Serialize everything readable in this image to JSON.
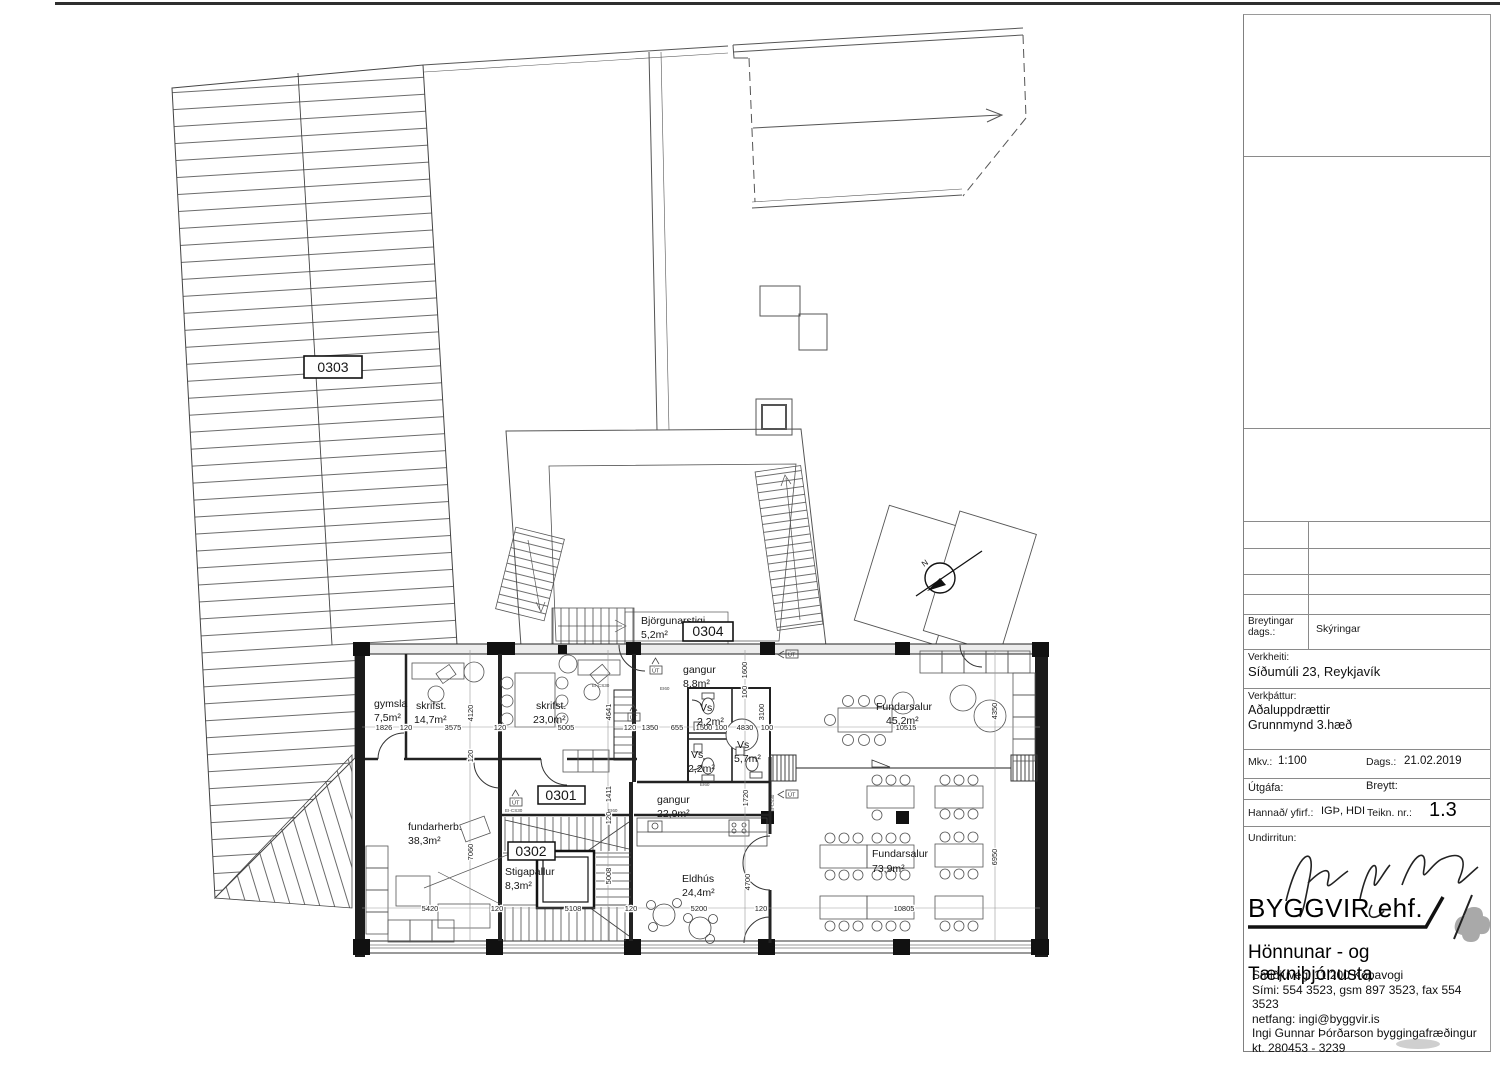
{
  "plan": {
    "tags": {
      "roof": "0303",
      "unit": "0301",
      "stair": "0302",
      "escape": "0304"
    },
    "rooms": {
      "gymsla": {
        "name": "gymsla",
        "area": "7,5m²"
      },
      "skrifst1": {
        "name": "skrifst.",
        "area": "14,7m²"
      },
      "skrifst2": {
        "name": "skrifst.",
        "area": "23,0m²"
      },
      "gangur1": {
        "name": "gangur",
        "area": "8,8m²"
      },
      "vs1": {
        "name": "Vs",
        "area": "2,2m²"
      },
      "vs2": {
        "name": "Vs",
        "area": "2,2m²"
      },
      "vs3": {
        "name": "Vs",
        "area": "5,7m²"
      },
      "fundarsalur1": {
        "name": "Fundarsalur",
        "area": "45,2m²"
      },
      "bjorgunarstigi": {
        "name": "Björgunarstigi",
        "area": "5,2m²"
      },
      "fundarherb": {
        "name": "fundarherb.",
        "area": "38,3m²"
      },
      "stigapallur": {
        "name": "Stigapallur",
        "area": "8,3m²"
      },
      "gangur2": {
        "name": "gangur",
        "area": "22,9m²"
      },
      "eldhus": {
        "name": "Eldhús",
        "area": "24,4m²"
      },
      "fundarsalur2": {
        "name": "Fundarsalur",
        "area": "73,9m²"
      }
    },
    "dims": {
      "d1826": "1826",
      "d120": "120",
      "d3575": "3575",
      "d5005": "5005",
      "d1350": "1350",
      "d655": "655",
      "d1500": "1500",
      "d100": "100",
      "d4830": "4830",
      "d10515": "10515",
      "d4120": "4120",
      "d4641": "4641",
      "d1411": "1411",
      "d1600": "1600",
      "d3100": "3100",
      "d4350": "4350",
      "d1720": "1720",
      "d7060": "7060",
      "d5420": "5420",
      "d5108": "5108",
      "d5008": "5008",
      "d5200": "5200",
      "d10805": "10805",
      "d6950": "6950",
      "d4700": "4700"
    },
    "marks": {
      "north": "N",
      "exit": "ÚT",
      "fire1": "EI-CS30",
      "fire2": "EI60"
    }
  },
  "titleblock": {
    "breytingar": "Breytingar",
    "dags_colon": "dags.:",
    "skyringar": "Skýringar",
    "verkheiti_label": "Verkheiti:",
    "verkheiti": "Síðumúli 23, Reykjavík",
    "verkthattur_label": "Verkþáttur:",
    "verkthattur1": "Aðaluppdrættir",
    "verkthattur2": "Grunnmynd 3.hæð",
    "mkv_label": "Mkv.:",
    "mkv": "1:100",
    "dags_label": "Dags.:",
    "dags": "21.02.2019",
    "utgafa_label": "Útgáfa:",
    "breytt_label": "Breytt:",
    "hannad_label": "Hannað/ yfirf.:",
    "hannad": "IGÞ, HDI",
    "teikn_label": "Teikn. nr.:",
    "teikn": "1.3",
    "undirritun_label": "Undirritun:"
  },
  "company": {
    "name": "BYGGVIR ehf.",
    "tagline": "Hönnunar - og Tækniþjónusta",
    "addr1": "Smiðjuvegi 11 200 Kópavogi",
    "addr2": "Sími: 554 3523, gsm 897 3523, fax 554 3523",
    "addr3": "netfang: ingi@byggvir.is",
    "addr4": "Ingi Gunnar Þórðarson byggingafræðingur",
    "addr5": "kt. 280453 - 3239"
  }
}
